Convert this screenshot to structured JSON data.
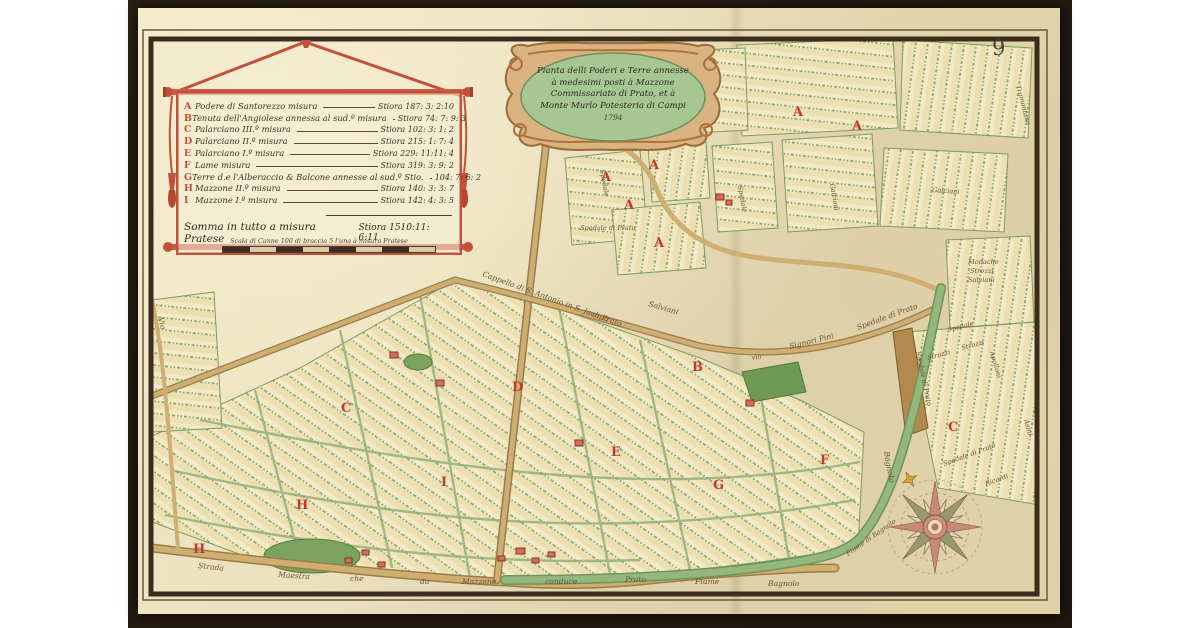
{
  "page": {
    "number": "9",
    "backdrop_color": "#241a10",
    "paper_color": "#eadfbc",
    "frame_color": "#3b2c1d",
    "legend_red": "#c2503a",
    "letter_red": "#c0392b",
    "cartouche_green": "#a6c694",
    "road_tan": "#cfae72",
    "river_green": "#94b77d"
  },
  "legend": {
    "entries": [
      {
        "letter": "A",
        "name": "Podere di Santorezzo misura",
        "value": "Stiora 187: 3: 2:10"
      },
      {
        "letter": "B",
        "name": "Tenuta dell'Angiolese annessa al sud.º misura",
        "value": "Stiora 74: 7: 9: 3"
      },
      {
        "letter": "C",
        "name": "Palarciano III.º misura",
        "value": "Stiora 102: 3: 1: 2"
      },
      {
        "letter": "D",
        "name": "Palarciano II.º misura",
        "value": "Stiora 215: 1: 7: 4"
      },
      {
        "letter": "E",
        "name": "Palarciano I.º misura",
        "value": "Stiora 229: 11:11: 4"
      },
      {
        "letter": "F",
        "name": "Lame misura",
        "value": "Stiora 319: 3: 9: 2"
      },
      {
        "letter": "G",
        "name": "Terre d.e l'Alberaccio & Balcone annesse al sud.º Stio.",
        "value": "104: 7: 6: 2"
      },
      {
        "letter": "H",
        "name": "Mazzone II.º misura",
        "value": "Stiora 140: 3: 3: 7"
      },
      {
        "letter": "I",
        "name": "Mazzone I.º misura",
        "value": "Stiora 142: 4: 3: 5"
      }
    ],
    "total_label": "Somma in tutto a misura Pratese",
    "total_value": "Stiora 1510:11: 6:11",
    "scale_caption": "Scala di Canne 100 di braccia 5 l'una à misura Pratese"
  },
  "cartouche": {
    "lines": [
      "Pianta delli Poderi e Terre annesse",
      "à medesimi posti à Mazzone",
      "Commissariato di Prato, et à",
      "Monte Murlo Potesteria di Campi"
    ],
    "date": "1794"
  },
  "map": {
    "letters": [
      "A",
      "A",
      "A",
      "A",
      "A",
      "A",
      "B",
      "C",
      "C",
      "D",
      "E",
      "F",
      "G",
      "H",
      "H",
      "I"
    ],
    "labels": [
      {
        "text": "Via"
      },
      {
        "text": "Cappella di S. Antonio in S. Jacopo"
      },
      {
        "text": "di Prato"
      },
      {
        "text": "Salviani"
      },
      {
        "text": "via"
      },
      {
        "text": "Signori Pini"
      },
      {
        "text": "Spedale di Prato"
      },
      {
        "text": "Spedale"
      },
      {
        "text": "Spedale di Prato"
      },
      {
        "text": "Spedale"
      },
      {
        "text": "Galciani"
      },
      {
        "text": "Galciani"
      },
      {
        "text": "Tramontana"
      },
      {
        "text": "Monache"
      },
      {
        "text": "Strozzi"
      },
      {
        "text": "Salviani"
      },
      {
        "text": "Strozzi"
      },
      {
        "text": "Spedale"
      },
      {
        "text": "Strozzi"
      },
      {
        "text": "Apolloni"
      },
      {
        "text": "Spedale di Prato"
      },
      {
        "text": "Spedale di Prato"
      },
      {
        "text": "Ricordi"
      },
      {
        "text": "Asini"
      },
      {
        "text": "Strada"
      },
      {
        "text": "Maestra"
      },
      {
        "text": "che"
      },
      {
        "text": "da"
      },
      {
        "text": "Mazzone"
      },
      {
        "text": "conduce"
      },
      {
        "text": "Prato"
      },
      {
        "text": "Fiume"
      },
      {
        "text": "Bagnolo"
      },
      {
        "text": "Bagnolo"
      },
      {
        "text": "Fiume di Bagnolo"
      }
    ]
  }
}
